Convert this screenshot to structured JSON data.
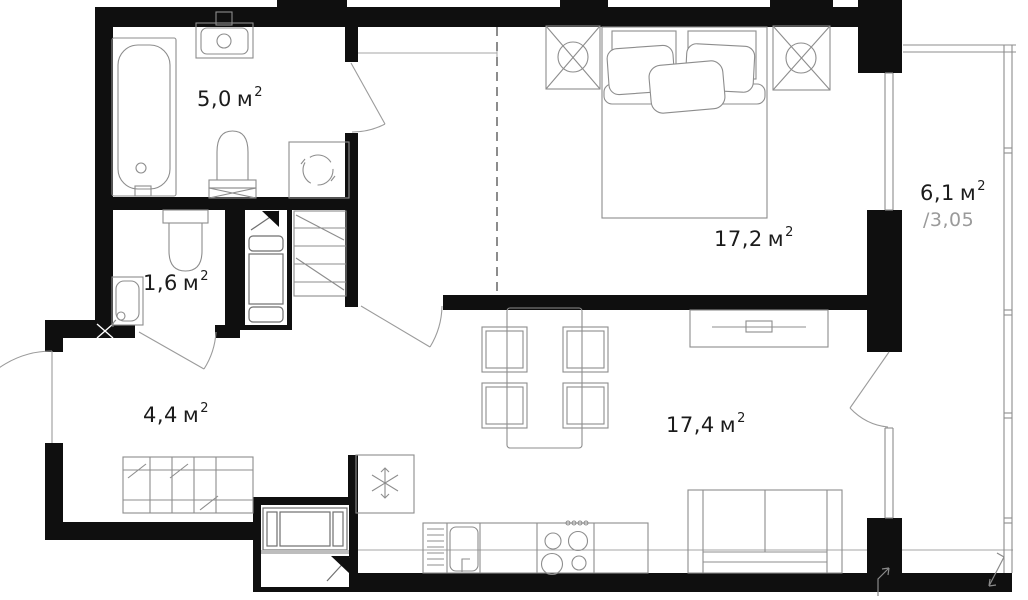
{
  "plan": {
    "type": "apartment-floor-plan",
    "rooms": {
      "bathroom": {
        "area": "5,0",
        "unit": "м",
        "sup": "2"
      },
      "wc": {
        "area": "1,6",
        "unit": "м",
        "sup": "2"
      },
      "hallway": {
        "area": "4,4",
        "unit": "м",
        "sup": "2"
      },
      "bedroom": {
        "area": "17,2",
        "unit": "м",
        "sup": "2"
      },
      "living_kitchen": {
        "area": "17,4",
        "unit": "м",
        "sup": "2"
      },
      "balcony": {
        "area": "6,1",
        "unit": "м",
        "sup": "2",
        "coefficient": "/3,05"
      }
    },
    "colors": {
      "wall": "#0f0f0f",
      "line": "#8d8d8d",
      "line2": "#6f6f6f",
      "thin": "#a6a6a6",
      "dash": "#4f4f4f",
      "text": "#1b1b1b",
      "muted": "#9a9a9a"
    },
    "symbols": [
      "snowflake-icon",
      "lamp-cross-icon",
      "flag-icon",
      "washer-drum-icon",
      "direction-arrow-icon"
    ]
  }
}
